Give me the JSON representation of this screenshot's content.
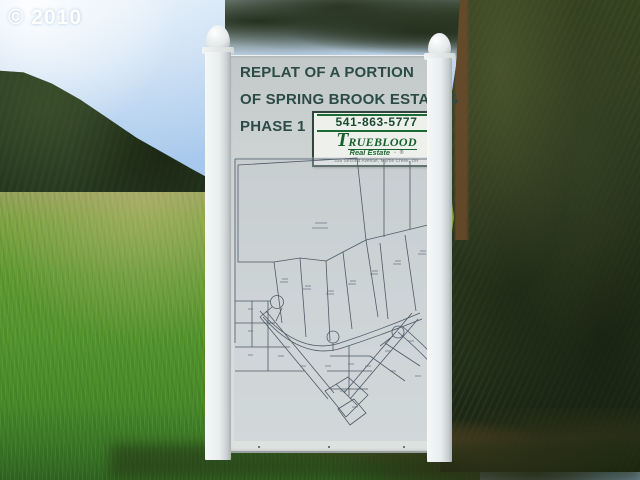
{
  "watermark": {
    "text": "© 2010"
  },
  "sign": {
    "title_line1": "REPLAT OF A PORTION",
    "title_line2": "OF SPRING BROOK ESTATES",
    "title_line3": "PHASE 1",
    "title_color": "#2d4b45",
    "contact": {
      "phone": "541-863-5777",
      "brand_initial": "T",
      "brand_rest": "RUEBLOOD",
      "brand_sub": "Real Estate",
      "brand_mark1": "▫",
      "brand_mark2": "®",
      "address": "335 Second Avenue,  Myrtle Creek, OR",
      "brand_color": "#14622e"
    }
  },
  "scene": {
    "sky_color": "#a3c6ec",
    "hill_color": "#27391f",
    "meadow_color": "#53932c",
    "trees_color": "#2c3a1e",
    "post_color": "#e9edee",
    "board_color": "#d2d8d7",
    "map_line_color": "#4d5a66"
  }
}
